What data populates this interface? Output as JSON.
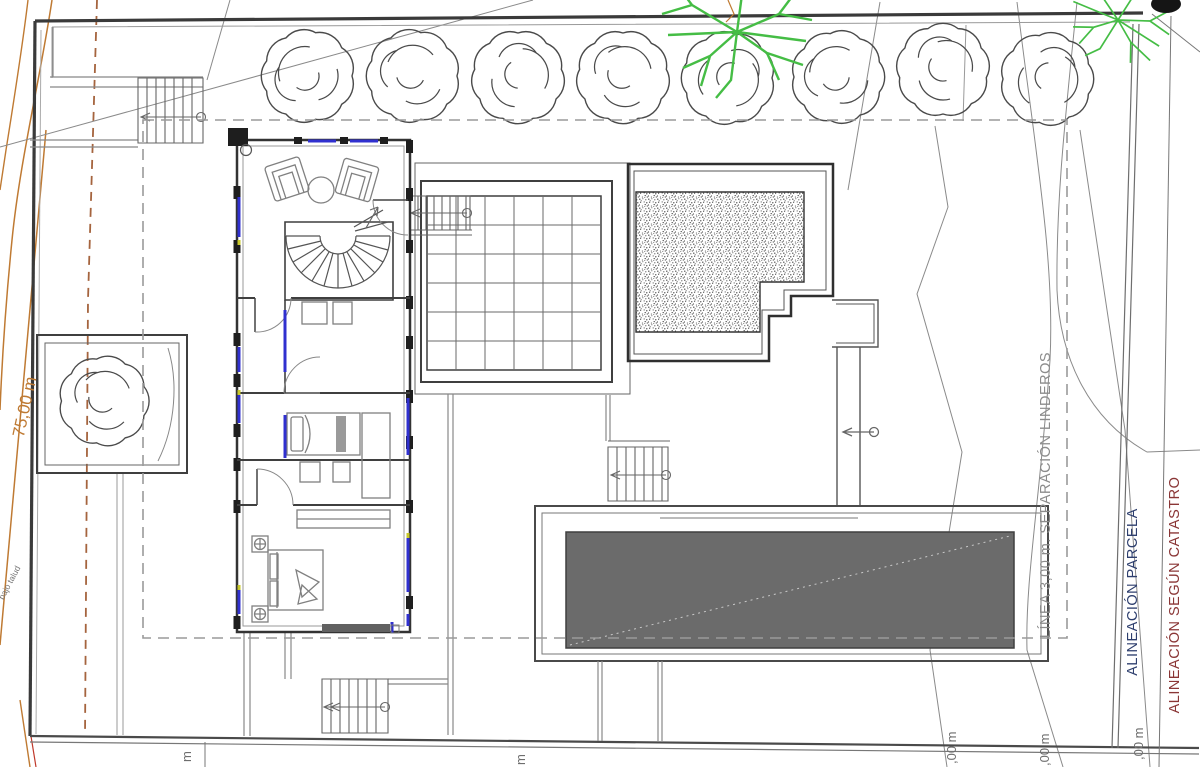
{
  "labels": {
    "left_dimension": "75,00 m",
    "slope_note": "bajo talud",
    "setback_line": "LÍNEA 3,00 m. SEPARACIÓN LINDEROS",
    "parcel_alignment": "ALINEACIÓN PARCELA",
    "cadastre_alignment": "ALINEACIÓN SEGÚN CATASTRO",
    "bottom_dim_fragment_1": ",00 m",
    "bottom_dim_fragment_2": ",00 m",
    "bottom_dim_fragment_3": ",00 m",
    "bottom_meter_1": "m",
    "bottom_meter_2": "m"
  },
  "colors": {
    "line_dark": "#3a3a3a",
    "line_medium": "#777777",
    "contour_orange": "#bf7a33",
    "boundary_brown_dash": "#a5643e",
    "window_blue": "#3030cf",
    "tree_green": "#45bd45",
    "pool_water": "#6b6b6b",
    "setback_text_gray": "#8c8c8c",
    "parcel_text_navy": "#2e3f6e",
    "cadastre_text_red": "#8a3636"
  }
}
